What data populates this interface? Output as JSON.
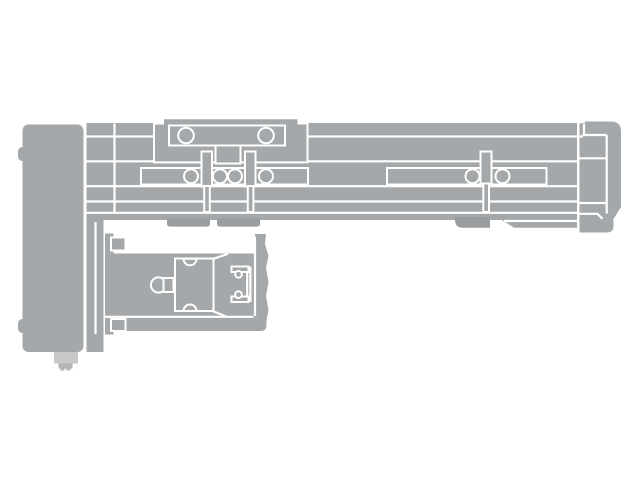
{
  "figure": {
    "alt": "Gray technical line drawing of a linear actuator slide unit, top view: long slide beam with carriage and bearing circles, right end cap, left motor housing block with connector foot, and a parallel motor unit folded underneath",
    "background": "#ffffff",
    "colors": {
      "body": "#a5a8aa",
      "body_dark": "#9a9da0",
      "foot_light": "#c6c8ca",
      "foot_mid": "#b2b4b6",
      "line": "#ffffff"
    }
  }
}
